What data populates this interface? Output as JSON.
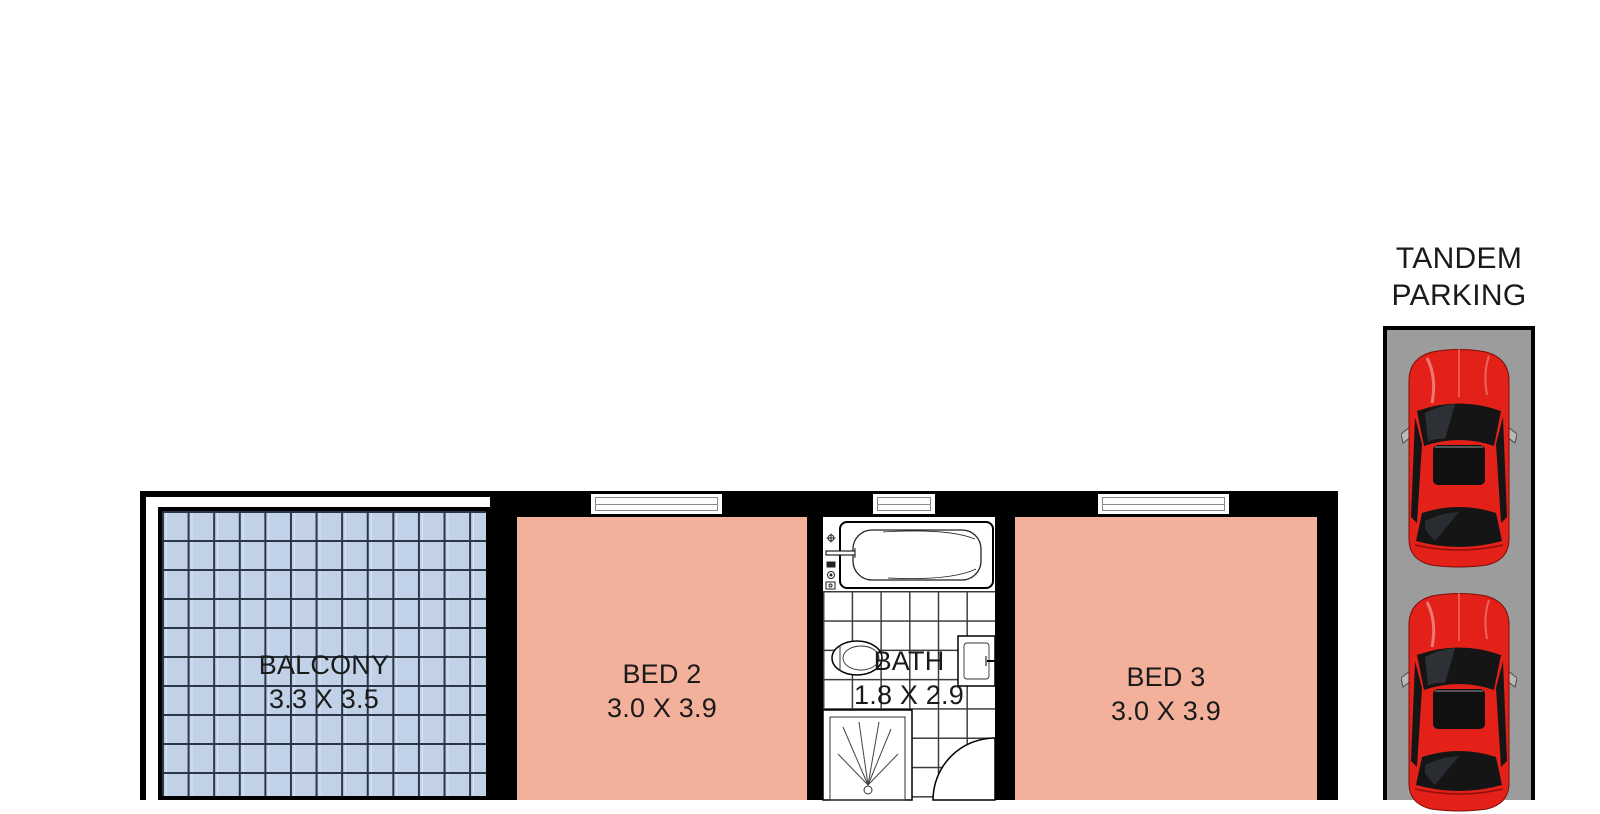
{
  "colors": {
    "wall": "#000000",
    "bedroom_fill": "#f3b19c",
    "balcony_fill": "#c0d1e8",
    "balcony_line": "#2a3545",
    "tile_line": "#3c3c3c",
    "strip_fill": "#9c9c9c",
    "car_red": "#e32119",
    "text": "#1a1a1a"
  },
  "floorplan": {
    "balcony": {
      "name": "BALCONY",
      "dims": "3.3 X 3.5"
    },
    "bed2": {
      "name": "BED 2",
      "dims": "3.0 X 3.9"
    },
    "bath": {
      "name": "BATH",
      "dims": "1.8 X 2.9"
    },
    "bed3": {
      "name": "BED 3",
      "dims": "3.0 X 3.9"
    },
    "windows": 3,
    "fixtures": [
      "bathtub",
      "toilet",
      "sink",
      "shower",
      "door-swing"
    ]
  },
  "parking": {
    "line1": "TANDEM",
    "line2": "PARKING",
    "cars": 2
  }
}
